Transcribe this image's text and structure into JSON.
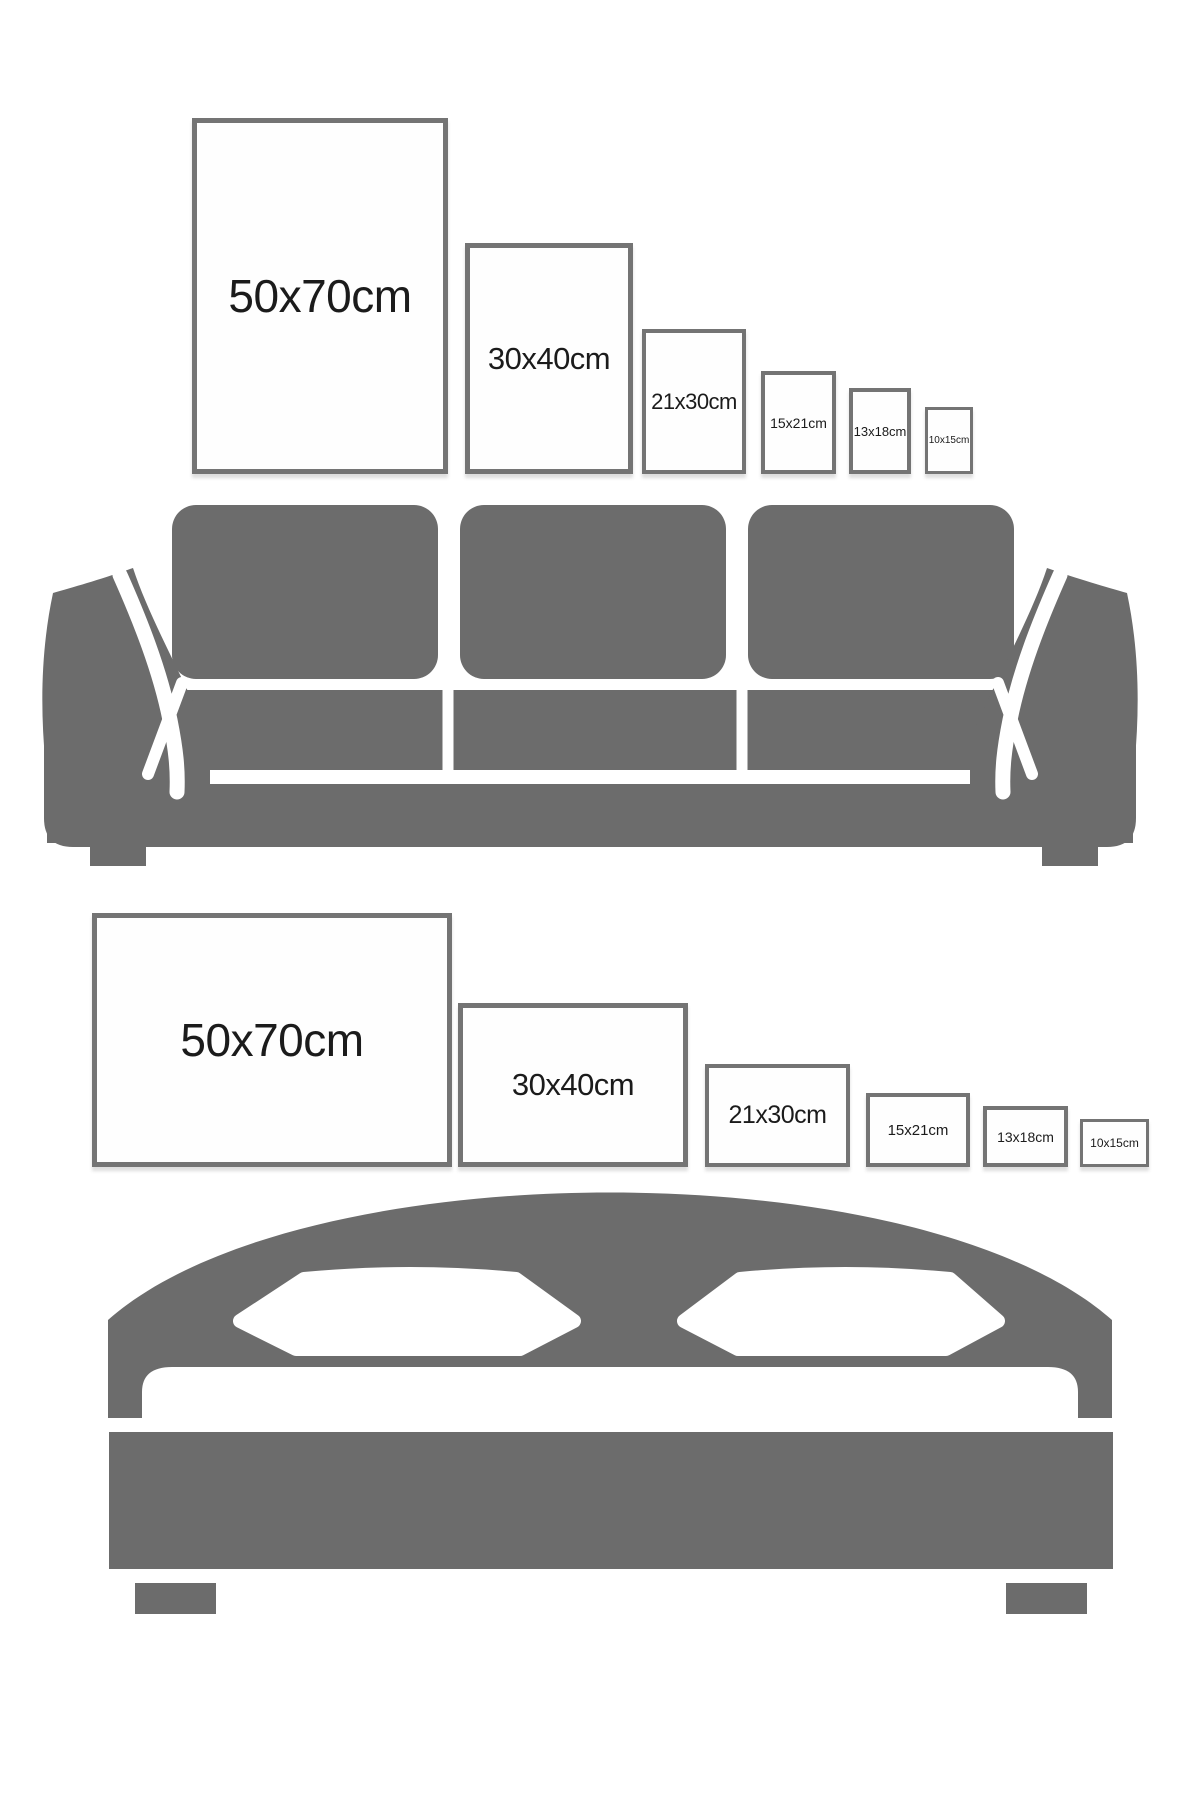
{
  "page": {
    "title": "Poster size comparison wall chart",
    "background": "#ffffff"
  },
  "colors": {
    "furniture_gray": "#6c6c6c",
    "frame_border": "#747474",
    "label_text": "#1b1b1b"
  },
  "top_section": {
    "furniture": "sofa-illustration",
    "frames": [
      {
        "label": "50x70cm",
        "orientation": "portrait"
      },
      {
        "label": "30x40cm",
        "orientation": "portrait"
      },
      {
        "label": "21x30cm",
        "orientation": "portrait"
      },
      {
        "label": "15x21cm",
        "orientation": "portrait"
      },
      {
        "label": "13x18cm",
        "orientation": "portrait"
      },
      {
        "label": "10x15cm",
        "orientation": "portrait"
      }
    ]
  },
  "bottom_section": {
    "furniture": "bed-illustration",
    "frames": [
      {
        "label": "50x70cm",
        "orientation": "landscape"
      },
      {
        "label": "30x40cm",
        "orientation": "landscape"
      },
      {
        "label": "21x30cm",
        "orientation": "landscape"
      },
      {
        "label": "15x21cm",
        "orientation": "landscape"
      },
      {
        "label": "13x18cm",
        "orientation": "landscape"
      },
      {
        "label": "10x15cm",
        "orientation": "landscape"
      }
    ]
  }
}
